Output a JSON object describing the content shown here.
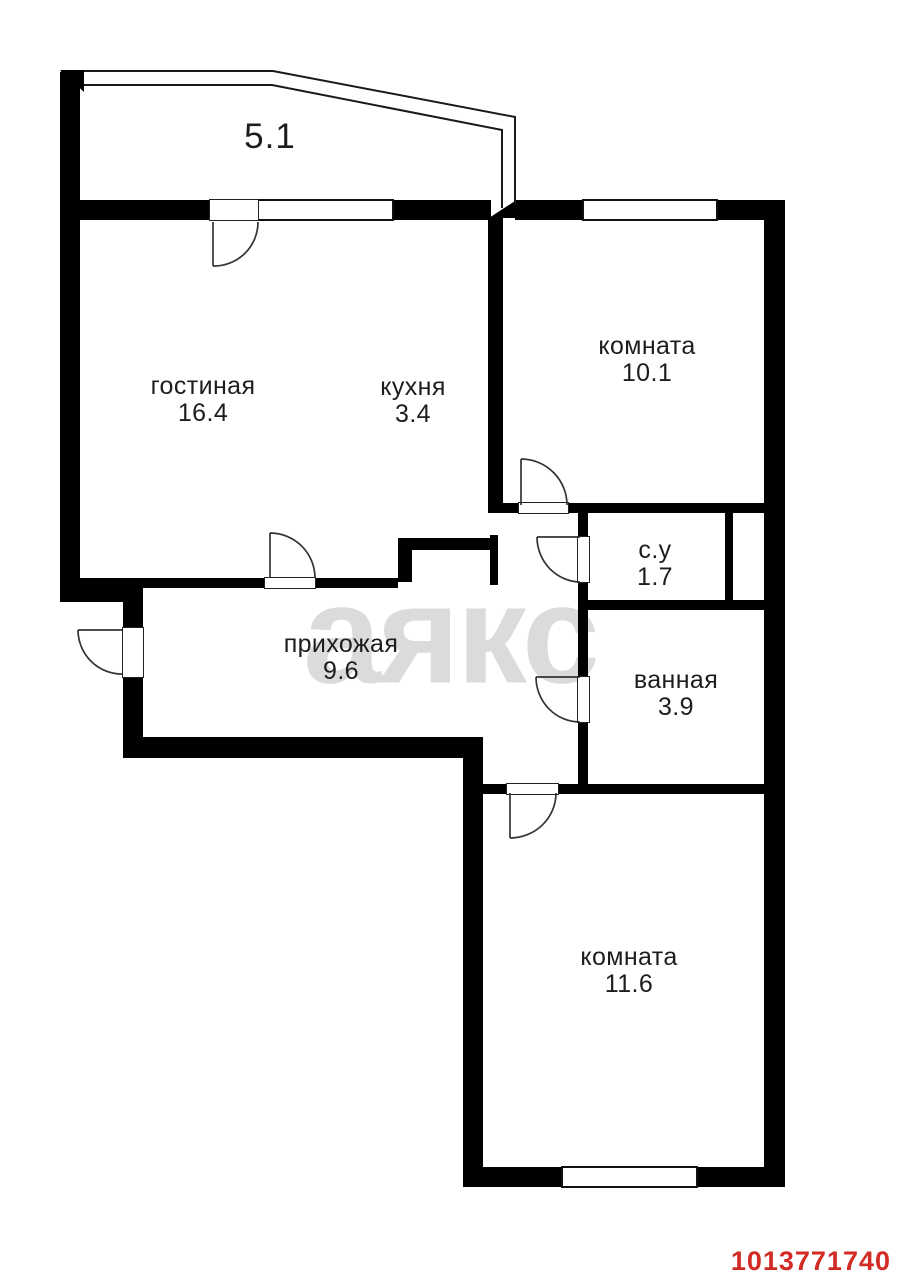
{
  "plan": {
    "rooms": [
      {
        "id": "living-room",
        "name": "гостиная",
        "area": "16.4"
      },
      {
        "id": "kitchen",
        "name": "кухня",
        "area": "3.4"
      },
      {
        "id": "room-top",
        "name": "комната",
        "area": "10.1"
      },
      {
        "id": "wc",
        "name": "с.у",
        "area": "1.7"
      },
      {
        "id": "bathroom",
        "name": "ванная",
        "area": "3.9"
      },
      {
        "id": "hallway",
        "name": "прихожая",
        "area": "9.6"
      },
      {
        "id": "room-bottom",
        "name": "комната",
        "area": "11.6"
      },
      {
        "id": "balcony",
        "name": "балкон",
        "area": "5.1"
      }
    ]
  },
  "watermark": {
    "text": "аякс",
    "color": "#dbdbdb"
  },
  "listing_id": {
    "value": "1013771740",
    "color": "#d22b25"
  },
  "colors": {
    "wall": "#000000",
    "background": "#ffffff",
    "label": "#1d1d1d"
  }
}
